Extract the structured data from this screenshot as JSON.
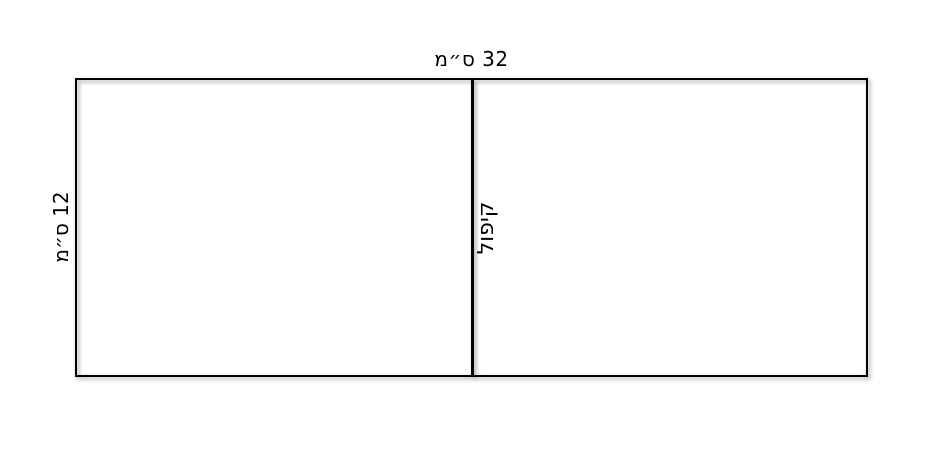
{
  "diagram": {
    "title_semantic": "folded-rectangle-geometry-figure",
    "top_dimension_label": "32 ס״מ",
    "left_dimension_label": "12 ס״מ",
    "fold_label": "קיפול",
    "dimensions": {
      "width_cm": 32,
      "height_cm": 12,
      "unit": "ס״מ"
    },
    "colors": {
      "line": "#000000",
      "background": "#ffffff",
      "text": "#000000",
      "shadow": "rgba(0,0,0,0.40)"
    }
  }
}
